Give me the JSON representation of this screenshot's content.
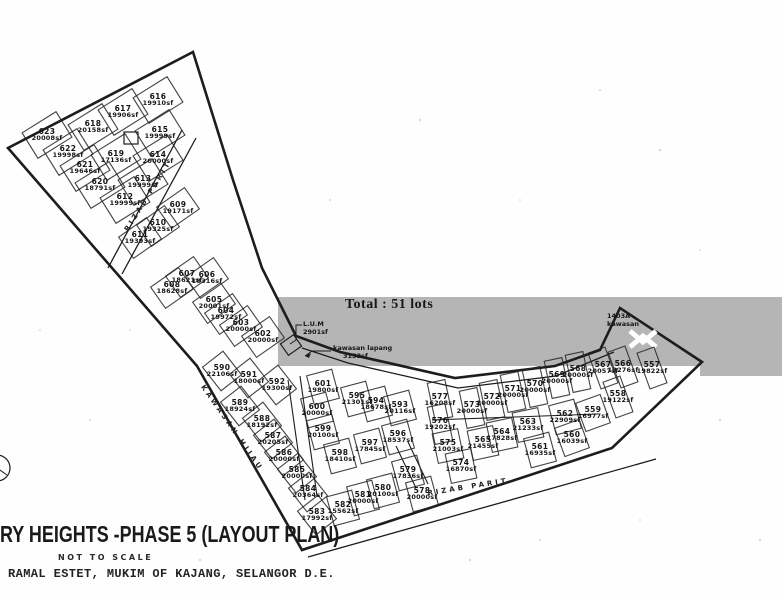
{
  "title": {
    "main": "RY HEIGHTS -PHASE 5 (LAYOUT PLAN)",
    "scale_note": "NOT TO SCALE",
    "address": "RAMAL ESTET, MUKIM OF KAJANG, SELANGOR D.E."
  },
  "annotations": {
    "total": "Total : 51 lots",
    "lus_line1": "L.U.M",
    "lus_line2": "2901sf",
    "open_space_line1": "kawasan lapang",
    "open_space_line2": "3133sf",
    "tip_line1": "1403A",
    "tip_line2": "kawasan"
  },
  "road_labels": [
    {
      "text": "RIZAB PARIT",
      "x": 148,
      "y": 196,
      "r": -58
    },
    {
      "text": "RIZAB PARIT",
      "x": 468,
      "y": 487,
      "r": -9
    },
    {
      "text": "KAWASAN HIJAU",
      "x": 232,
      "y": 428,
      "r": 55
    }
  ],
  "colors": {
    "ink": "#1d1d1d",
    "scan_band": "#b5b5b5",
    "paper": "#fefefe"
  },
  "lots": [
    {
      "n": "623",
      "s": "20008sf",
      "x": 47,
      "y": 135,
      "r": -32,
      "g": "a"
    },
    {
      "n": "622",
      "s": "19998sf",
      "x": 68,
      "y": 152,
      "r": -32,
      "g": "a"
    },
    {
      "n": "621",
      "s": "19646sf",
      "x": 85,
      "y": 168,
      "r": -32,
      "g": "a"
    },
    {
      "n": "620",
      "s": "18791sf",
      "x": 100,
      "y": 185,
      "r": -32,
      "g": "a"
    },
    {
      "n": "619",
      "s": "17136sf",
      "x": 116,
      "y": 157,
      "r": -32,
      "g": "a"
    },
    {
      "n": "618",
      "s": "20158sf",
      "x": 93,
      "y": 127,
      "r": -32,
      "g": "a"
    },
    {
      "n": "617",
      "s": "19906sf",
      "x": 123,
      "y": 112,
      "r": -32,
      "g": "a"
    },
    {
      "n": "616",
      "s": "19910sf",
      "x": 158,
      "y": 100,
      "r": -32,
      "g": "a"
    },
    {
      "n": "615",
      "s": "19999sf",
      "x": 160,
      "y": 133,
      "r": -32,
      "g": "a"
    },
    {
      "n": "614",
      "s": "20000sf",
      "x": 158,
      "y": 158,
      "r": -32,
      "g": "a"
    },
    {
      "n": "613",
      "s": "19999sf",
      "x": 143,
      "y": 182,
      "r": -32,
      "g": "a"
    },
    {
      "n": "612",
      "s": "19999sf",
      "x": 125,
      "y": 200,
      "r": -32,
      "g": "a"
    },
    {
      "n": "611",
      "s": "19393sf",
      "x": 140,
      "y": 238,
      "r": -35,
      "g": "b"
    },
    {
      "n": "610",
      "s": "19325sf",
      "x": 158,
      "y": 226,
      "r": -35,
      "g": "b"
    },
    {
      "n": "609",
      "s": "19171sf",
      "x": 178,
      "y": 208,
      "r": -35,
      "g": "b"
    },
    {
      "n": "608",
      "s": "18628sf",
      "x": 172,
      "y": 288,
      "r": -35,
      "g": "b"
    },
    {
      "n": "607",
      "s": "18621sf",
      "x": 187,
      "y": 277,
      "r": -35,
      "g": "b"
    },
    {
      "n": "606",
      "s": "18316sf",
      "x": 207,
      "y": 278,
      "r": -35,
      "g": "b"
    },
    {
      "n": "605",
      "s": "20001sf",
      "x": 214,
      "y": 303,
      "r": -35,
      "g": "b"
    },
    {
      "n": "604",
      "s": "19972sf",
      "x": 226,
      "y": 314,
      "r": -35,
      "g": "b"
    },
    {
      "n": "603",
      "s": "20000sf",
      "x": 241,
      "y": 326,
      "r": -35,
      "g": "b"
    },
    {
      "n": "602",
      "s": "20000sf",
      "x": 263,
      "y": 337,
      "r": -35,
      "g": "b"
    },
    {
      "n": "590",
      "s": "22106sf",
      "x": 222,
      "y": 371,
      "r": -38,
      "g": "d"
    },
    {
      "n": "591",
      "s": "18000sf",
      "x": 249,
      "y": 378,
      "r": -38,
      "g": "d"
    },
    {
      "n": "592",
      "s": "19300sf",
      "x": 277,
      "y": 385,
      "r": -38,
      "g": "d"
    },
    {
      "n": "589",
      "s": "18924sf",
      "x": 240,
      "y": 406,
      "r": -38,
      "g": "d"
    },
    {
      "n": "588",
      "s": "18192sf",
      "x": 262,
      "y": 422,
      "r": -38,
      "g": "d"
    },
    {
      "n": "587",
      "s": "20205sf",
      "x": 273,
      "y": 439,
      "r": -38,
      "g": "d"
    },
    {
      "n": "586",
      "s": "20000sf",
      "x": 284,
      "y": 456,
      "r": -38,
      "g": "d"
    },
    {
      "n": "585",
      "s": "20000sf",
      "x": 297,
      "y": 473,
      "r": -38,
      "g": "d"
    },
    {
      "n": "584",
      "s": "20364sf",
      "x": 308,
      "y": 492,
      "r": -38,
      "g": "d"
    },
    {
      "n": "583",
      "s": "17992sf",
      "x": 317,
      "y": 515,
      "r": -38,
      "g": "d"
    },
    {
      "n": "582",
      "s": "15562sf",
      "x": 343,
      "y": 508,
      "r": -15,
      "g": "d"
    },
    {
      "n": "581",
      "s": "20000sf",
      "x": 363,
      "y": 498,
      "r": -15,
      "g": "d"
    },
    {
      "n": "580",
      "s": "20100sf",
      "x": 383,
      "y": 491,
      "r": -15,
      "g": "d"
    },
    {
      "n": "579",
      "s": "17836sf",
      "x": 408,
      "y": 473,
      "r": -15,
      "g": "d"
    },
    {
      "n": "578",
      "s": "20000sf",
      "x": 422,
      "y": 494,
      "r": -15,
      "g": "d"
    },
    {
      "n": "601",
      "s": "19800sf",
      "x": 323,
      "y": 387,
      "r": -15,
      "g": "d"
    },
    {
      "n": "600",
      "s": "20000sf",
      "x": 317,
      "y": 410,
      "r": -15,
      "g": "d"
    },
    {
      "n": "599",
      "s": "20100sf",
      "x": 323,
      "y": 432,
      "r": -15,
      "g": "d"
    },
    {
      "n": "598",
      "s": "18410sf",
      "x": 340,
      "y": 456,
      "r": -15,
      "g": "d"
    },
    {
      "n": "597",
      "s": "17845sf",
      "x": 370,
      "y": 446,
      "r": -15,
      "g": "d"
    },
    {
      "n": "596",
      "s": "18537sf",
      "x": 398,
      "y": 437,
      "r": -15,
      "g": "d"
    },
    {
      "n": "595",
      "s": "21301sf",
      "x": 357,
      "y": 399,
      "r": -15,
      "g": "d"
    },
    {
      "n": "594",
      "s": "18678sf",
      "x": 376,
      "y": 404,
      "r": -15,
      "g": "d"
    },
    {
      "n": "593",
      "s": "20116sf",
      "x": 400,
      "y": 408,
      "r": -15,
      "g": "d"
    },
    {
      "n": "577",
      "s": "16208sf",
      "x": 440,
      "y": 400,
      "r": -12,
      "g": "c"
    },
    {
      "n": "576",
      "s": "19202sf",
      "x": 440,
      "y": 424,
      "r": -12,
      "g": "c"
    },
    {
      "n": "575",
      "s": "21003sf",
      "x": 448,
      "y": 446,
      "r": -12,
      "g": "d"
    },
    {
      "n": "574",
      "s": "16870sf",
      "x": 461,
      "y": 466,
      "r": -12,
      "g": "d"
    },
    {
      "n": "573",
      "s": "20000sf",
      "x": 472,
      "y": 408,
      "r": -12,
      "g": "c"
    },
    {
      "n": "572",
      "s": "20000sf",
      "x": 492,
      "y": 400,
      "r": -12,
      "g": "c"
    },
    {
      "n": "571",
      "s": "20000sf",
      "x": 513,
      "y": 392,
      "r": -12,
      "g": "c"
    },
    {
      "n": "570",
      "s": "20000sf",
      "x": 535,
      "y": 387,
      "r": -12,
      "g": "c"
    },
    {
      "n": "569",
      "s": "20000sf",
      "x": 557,
      "y": 378,
      "r": -12,
      "g": "c"
    },
    {
      "n": "568",
      "s": "20000sf",
      "x": 578,
      "y": 372,
      "r": -12,
      "g": "c"
    },
    {
      "n": "567",
      "s": "20057sf",
      "x": 603,
      "y": 368,
      "r": -20,
      "g": "c"
    },
    {
      "n": "566",
      "s": "13276sf",
      "x": 623,
      "y": 367,
      "r": -20,
      "g": "c"
    },
    {
      "n": "557",
      "s": "19822sf",
      "x": 652,
      "y": 368,
      "r": -20,
      "g": "c"
    },
    {
      "n": "558",
      "s": "19122sf",
      "x": 618,
      "y": 397,
      "r": -20,
      "g": "c"
    },
    {
      "n": "559",
      "s": "16977sf",
      "x": 593,
      "y": 413,
      "r": -20,
      "g": "d"
    },
    {
      "n": "560",
      "s": "16039sf",
      "x": 572,
      "y": 438,
      "r": -20,
      "g": "d"
    },
    {
      "n": "561",
      "s": "16935sf",
      "x": 540,
      "y": 450,
      "r": -15,
      "g": "d"
    },
    {
      "n": "562",
      "s": "22909sf",
      "x": 565,
      "y": 417,
      "r": -15,
      "g": "d"
    },
    {
      "n": "563",
      "s": "21233sf",
      "x": 528,
      "y": 425,
      "r": -12,
      "g": "d"
    },
    {
      "n": "564",
      "s": "17828sf",
      "x": 502,
      "y": 435,
      "r": -12,
      "g": "d"
    },
    {
      "n": "565",
      "s": "21455sf",
      "x": 483,
      "y": 443,
      "r": -12,
      "g": "d"
    }
  ]
}
